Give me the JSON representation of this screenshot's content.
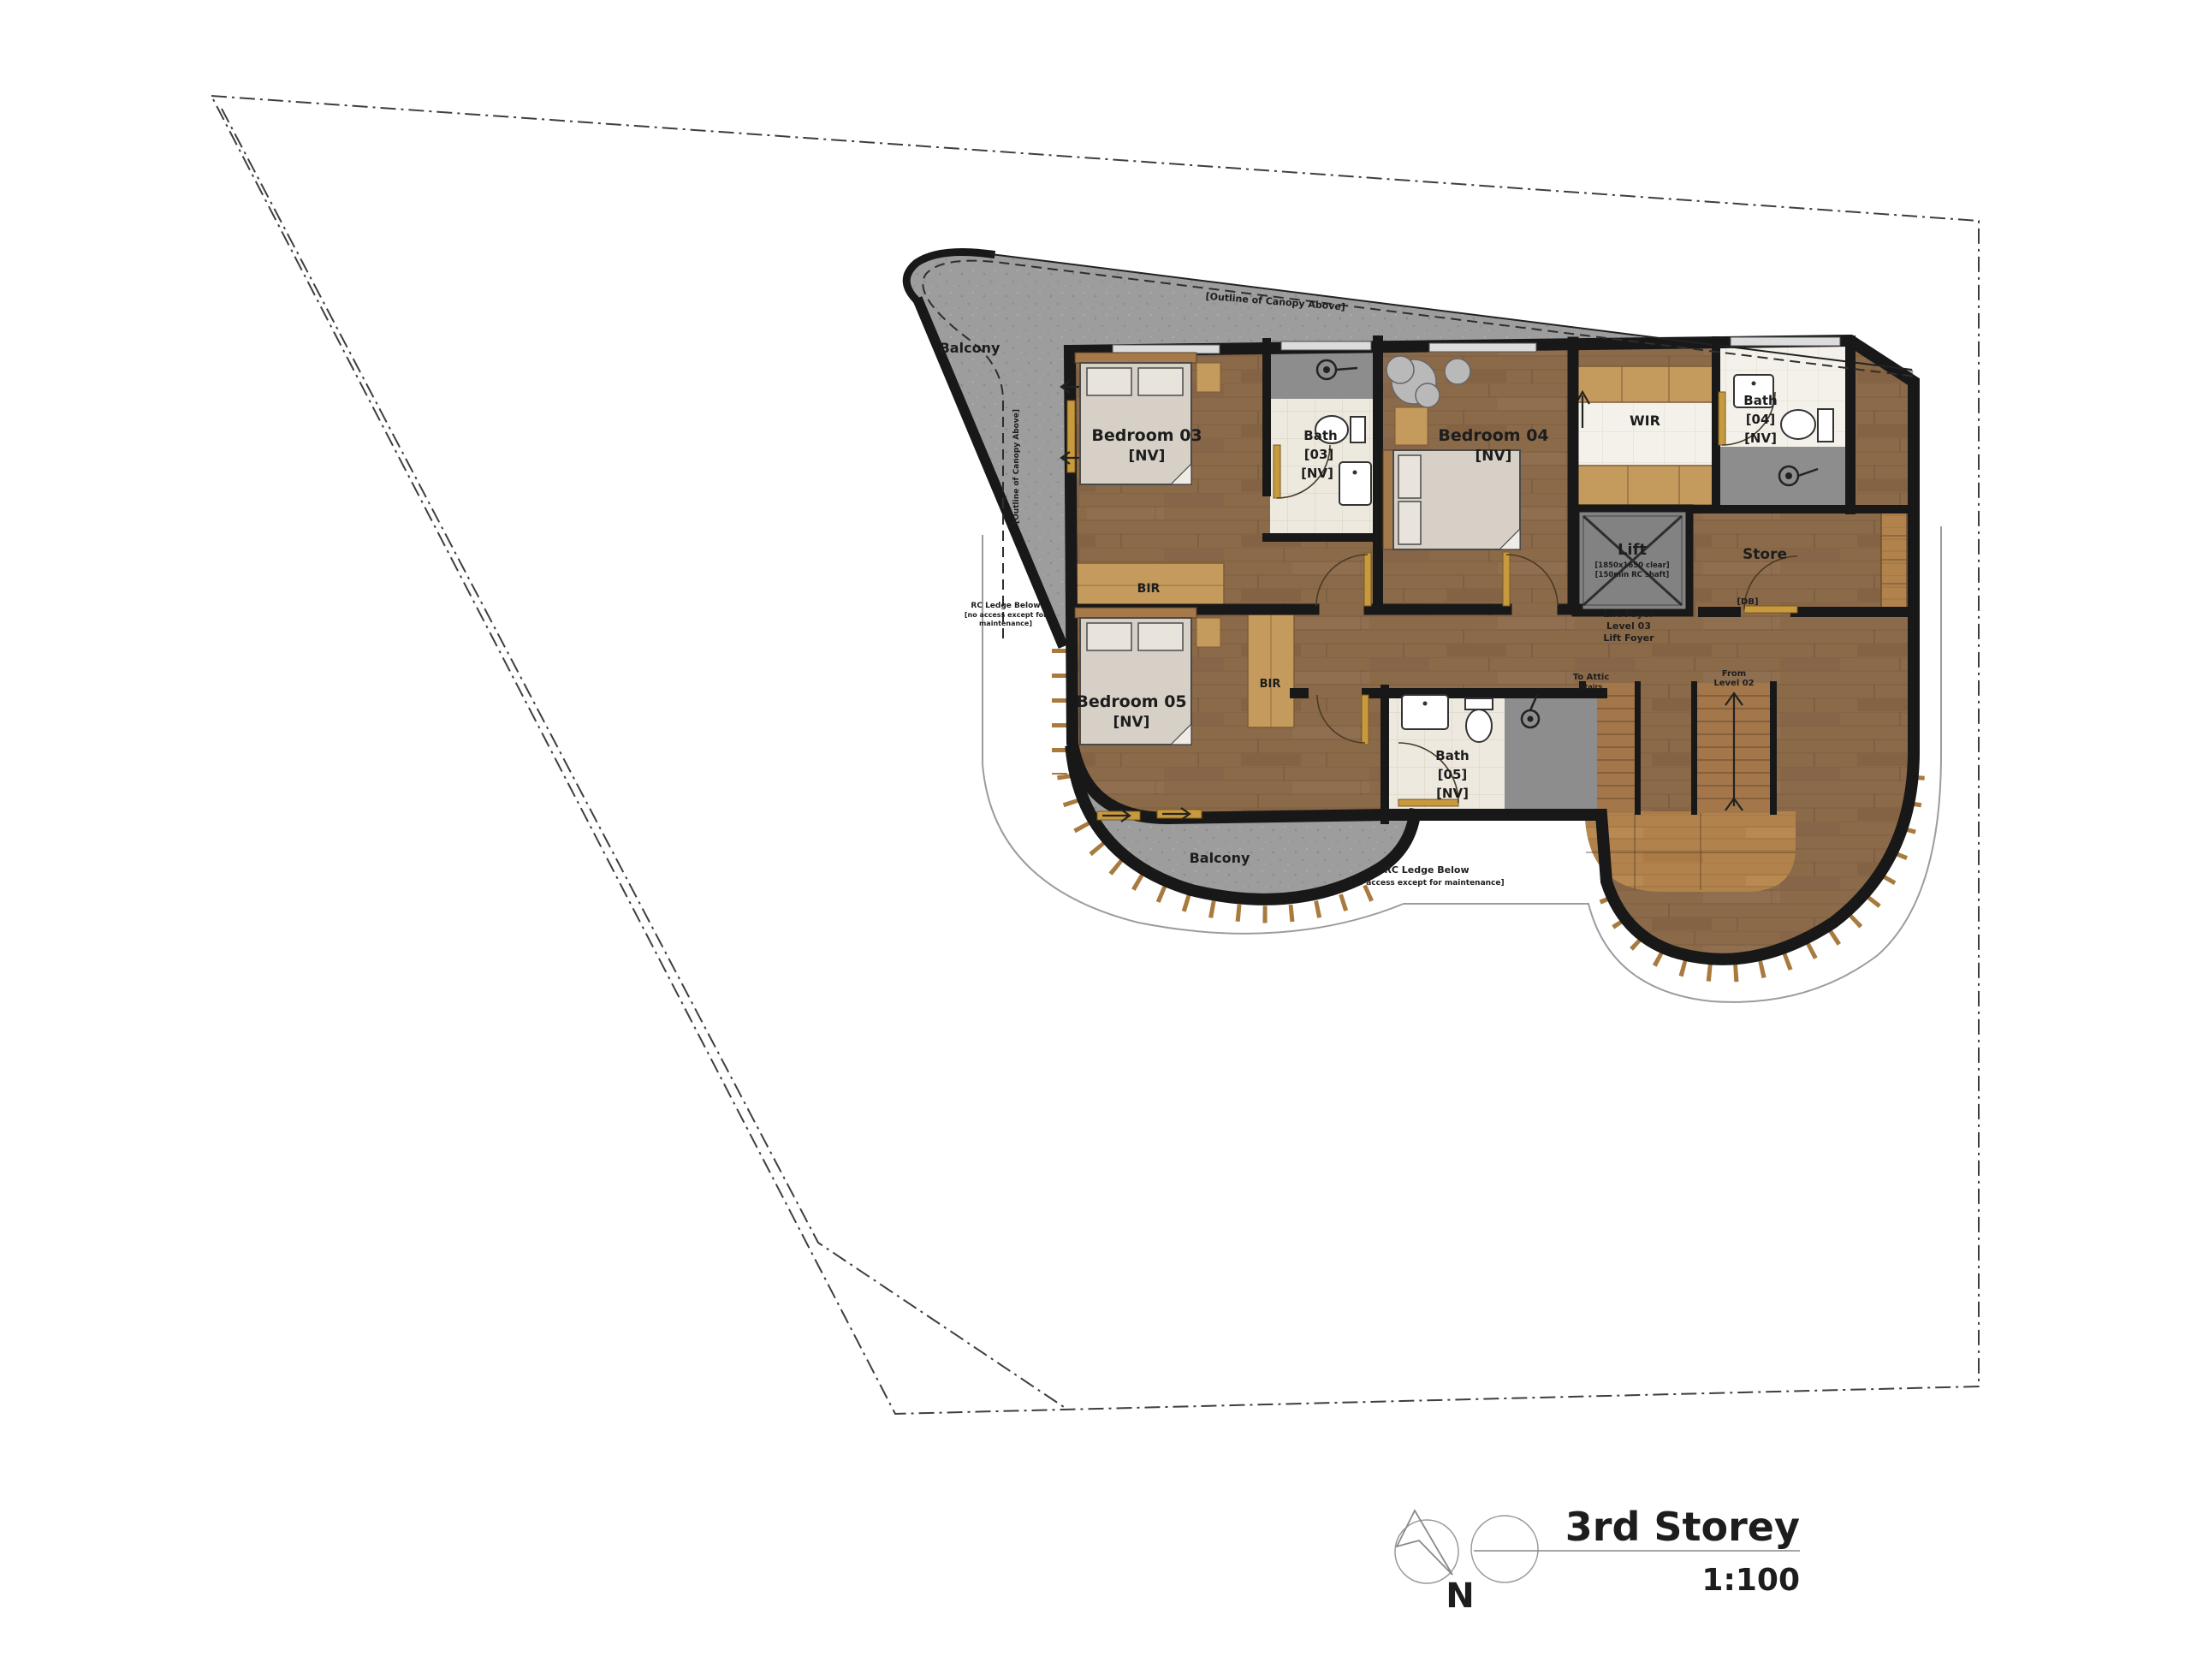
{
  "title": {
    "storey": "3rd Storey",
    "scale": "1:100"
  },
  "north": {
    "label": "N"
  },
  "rooms": {
    "balcony_top": "Balcony",
    "balcony_bottom": "Balcony",
    "bedroom03": "Bedroom 03",
    "bedroom03_nv": "[NV]",
    "bedroom04": "Bedroom 04",
    "bedroom04_nv": "[NV]",
    "bedroom05": "Bedroom 05",
    "bedroom05_nv": "[NV]",
    "bath03_l1": "Bath",
    "bath03_l2": "[03]",
    "bath03_l3": "[NV]",
    "bath04_l1": "Bath",
    "bath04_l2": "[04]",
    "bath04_l3": "[NV]",
    "bath05_l1": "Bath",
    "bath05_l2": "[05]",
    "bath05_l3": "[NV]",
    "wir": "WIR",
    "store": "Store",
    "db": "[DB]",
    "lift": "Lift",
    "lift_note1": "[1850x1650 clear]",
    "lift_note2": "[150min RC shaft]",
    "lift_foyer_l1": "Lift Foyer",
    "lift_foyer_l2": "Level 03",
    "lift_foyer_l3": "Lift Foyer",
    "bir_top": "BIR",
    "bir_bottom": "BIR"
  },
  "annotations": {
    "canopy_top": "[Outline of Canopy Above]",
    "canopy_side": "[Outline of Canopy Above]",
    "ledge_left_l1": "RC Ledge Below",
    "ledge_left_l2": "[no access except for",
    "ledge_left_l3": "maintenance]",
    "ledge_bottom_l1": "RC Ledge Below",
    "ledge_bottom_l2": "[no access except for maintenance]",
    "stairs_attic_l1": "To Attic",
    "stairs_attic_l2": "Stairs",
    "stairs_from_l1": "From",
    "stairs_from_l2": "Level 02"
  },
  "colors": {
    "wood": "#8b6a49",
    "wood_light": "#b2824d",
    "concrete": "#9d9d9d",
    "tile": "#eee9df",
    "shower_gray": "#8d8d8d",
    "wall": "#181818",
    "door_gold": "#c89a3e"
  }
}
